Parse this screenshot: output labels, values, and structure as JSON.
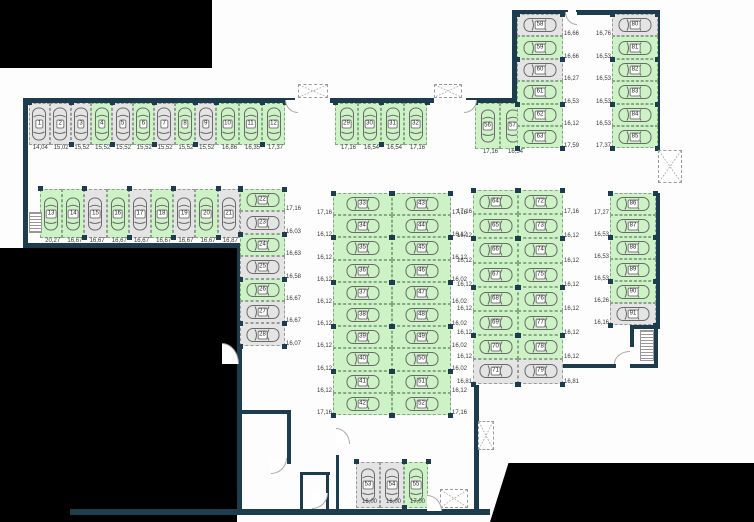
{
  "plan": {
    "colors": {
      "wall": "#1d3c4e",
      "free_stall": "#ccf2c5",
      "occupied_stall": "#e4e4e4",
      "background": "#fdfdfd",
      "outside": "#000000"
    },
    "outside": [
      {
        "x": 0,
        "y": 0,
        "w": 212,
        "h": 68
      },
      {
        "x": 0,
        "y": 248,
        "w": 237,
        "h": 274
      },
      {
        "x": 490,
        "y": 463,
        "w": 264,
        "h": 59,
        "clip": "polygon(0 100%, 7% 0, 100% 0, 100% 100%)"
      }
    ],
    "walls": [
      {
        "x": 23,
        "y": 98,
        "w": 272,
        "h": 5
      },
      {
        "x": 330,
        "y": 98,
        "w": 104,
        "h": 5
      },
      {
        "x": 466,
        "y": 98,
        "w": 52,
        "h": 5
      },
      {
        "x": 512,
        "y": 10,
        "w": 56,
        "h": 5
      },
      {
        "x": 576,
        "y": 10,
        "w": 84,
        "h": 5
      },
      {
        "x": 655,
        "y": 10,
        "w": 5,
        "h": 140
      },
      {
        "x": 512,
        "y": 10,
        "w": 5,
        "h": 95
      },
      {
        "x": 23,
        "y": 98,
        "w": 5,
        "h": 150
      },
      {
        "x": 23,
        "y": 243,
        "w": 218,
        "h": 5
      },
      {
        "x": 237,
        "y": 243,
        "w": 5,
        "h": 271
      },
      {
        "x": 70,
        "y": 509,
        "w": 420,
        "h": 6
      },
      {
        "x": 655,
        "y": 193,
        "w": 5,
        "h": 136
      },
      {
        "x": 630,
        "y": 325,
        "w": 28,
        "h": 4
      },
      {
        "x": 630,
        "y": 325,
        "w": 4,
        "h": 22
      },
      {
        "x": 654,
        "y": 325,
        "w": 4,
        "h": 43
      },
      {
        "x": 560,
        "y": 364,
        "w": 56,
        "h": 4
      },
      {
        "x": 630,
        "y": 364,
        "w": 28,
        "h": 4
      },
      {
        "x": 474,
        "y": 385,
        "w": 5,
        "h": 126
      },
      {
        "x": 238,
        "y": 410,
        "w": 53,
        "h": 4
      },
      {
        "x": 287,
        "y": 410,
        "w": 4,
        "h": 54
      },
      {
        "x": 300,
        "y": 472,
        "w": 30,
        "h": 3
      },
      {
        "x": 300,
        "y": 472,
        "w": 3,
        "h": 38
      },
      {
        "x": 326,
        "y": 472,
        "w": 3,
        "h": 38
      },
      {
        "x": 336,
        "y": 455,
        "w": 3,
        "h": 55
      }
    ],
    "hatches": [
      {
        "x": 298,
        "y": 84,
        "w": 30,
        "h": 14
      },
      {
        "x": 434,
        "y": 84,
        "w": 28,
        "h": 14
      },
      {
        "x": 658,
        "y": 150,
        "w": 24,
        "h": 33
      },
      {
        "x": 478,
        "y": 421,
        "w": 16,
        "h": 29
      },
      {
        "x": 440,
        "y": 489,
        "w": 28,
        "h": 19
      }
    ],
    "doors": [
      {
        "x": 285,
        "y": 100,
        "w": 13,
        "h": 13,
        "q": "bl"
      },
      {
        "x": 464,
        "y": 100,
        "w": 13,
        "h": 13,
        "q": "br"
      },
      {
        "x": 565,
        "y": 12,
        "w": 12,
        "h": 13,
        "q": "bl"
      },
      {
        "x": 222,
        "y": 343,
        "w": 17,
        "h": 21,
        "q": "tr"
      },
      {
        "x": 271,
        "y": 458,
        "w": 16,
        "h": 16,
        "q": "br"
      },
      {
        "x": 312,
        "y": 493,
        "w": 16,
        "h": 16,
        "q": "br"
      },
      {
        "x": 427,
        "y": 495,
        "w": 15,
        "h": 16,
        "q": "tr"
      },
      {
        "x": 614,
        "y": 351,
        "w": 16,
        "h": 13,
        "q": "tl"
      },
      {
        "x": 336,
        "y": 428,
        "w": 14,
        "h": 16,
        "q": "tr"
      }
    ],
    "stairs": [
      {
        "x": 29,
        "y": 212,
        "w": 13,
        "h": 21
      },
      {
        "x": 640,
        "y": 330,
        "w": 14,
        "h": 31
      }
    ],
    "blocks": [
      {
        "id": "row-1-9",
        "type": "row",
        "x": 29,
        "y": 103,
        "sw": 20.8,
        "sh": 42,
        "dim": "below",
        "stalls": [
          {
            "n": "1",
            "dim": "14,04",
            "free": false
          },
          {
            "n": "2",
            "dim": "15,02",
            "free": false
          },
          {
            "n": "3",
            "dim": "15,52",
            "free": false
          },
          {
            "n": "4",
            "dim": "15,52",
            "free": true
          },
          {
            "n": "5",
            "dim": "15,52",
            "free": false
          },
          {
            "n": "6",
            "dim": "15,52",
            "free": true
          },
          {
            "n": "7",
            "dim": "15,52",
            "free": false
          },
          {
            "n": "8",
            "dim": "15,52",
            "free": true
          },
          {
            "n": "9",
            "dim": "15,52",
            "free": false
          }
        ]
      },
      {
        "id": "row-10-12",
        "type": "row",
        "x": 216,
        "y": 103,
        "sw": 23,
        "sh": 42,
        "dim": "below",
        "stalls": [
          {
            "n": "10",
            "dim": "16,86",
            "free": true
          },
          {
            "n": "11",
            "dim": "16,35",
            "free": true
          },
          {
            "n": "12",
            "dim": "17,37",
            "free": true
          }
        ]
      },
      {
        "id": "row-29-32",
        "type": "row",
        "x": 335,
        "y": 103,
        "sw": 23,
        "sh": 42,
        "dim": "below",
        "stalls": [
          {
            "n": "29",
            "dim": "17,16",
            "free": true
          },
          {
            "n": "30",
            "dim": "16,54",
            "free": true
          },
          {
            "n": "31",
            "dim": "16,54",
            "free": true
          },
          {
            "n": "32",
            "dim": "17,16",
            "free": true
          }
        ]
      },
      {
        "id": "row-13-21",
        "type": "row",
        "x": 40,
        "y": 189,
        "sw": 22.2,
        "sh": 49,
        "dim": "below",
        "stalls": [
          {
            "n": "13",
            "dim": "20,27",
            "free": true
          },
          {
            "n": "14",
            "dim": "16,67",
            "free": true
          },
          {
            "n": "15",
            "dim": "16,67",
            "free": false
          },
          {
            "n": "16",
            "dim": "16,67",
            "free": true
          },
          {
            "n": "17",
            "dim": "16,67",
            "free": false
          },
          {
            "n": "18",
            "dim": "16,67",
            "free": true
          },
          {
            "n": "19",
            "dim": "16,67",
            "free": false
          },
          {
            "n": "20",
            "dim": "16,67",
            "free": true
          },
          {
            "n": "21",
            "dim": "16,87",
            "free": false
          }
        ]
      },
      {
        "id": "col-22-28",
        "type": "col",
        "x": 240,
        "y": 189,
        "w": 45,
        "sh": 22.4,
        "dim": "right",
        "stalls": [
          {
            "n": "22",
            "dim": "17,16",
            "free": true
          },
          {
            "n": "23",
            "dim": "16,03",
            "free": false
          },
          {
            "n": "24",
            "dim": "16,63",
            "free": true
          },
          {
            "n": "25",
            "dim": "16,58",
            "free": false
          },
          {
            "n": "26",
            "dim": "16,67",
            "free": true
          },
          {
            "n": "27",
            "dim": "16,67",
            "free": false
          },
          {
            "n": "28",
            "dim": "16,07",
            "free": false
          }
        ]
      },
      {
        "id": "col-33-42",
        "type": "col",
        "x": 333,
        "y": 193,
        "w": 59,
        "sh": 22.2,
        "dim": "left",
        "stalls": [
          {
            "n": "33",
            "dim": "17,16",
            "free": true
          },
          {
            "n": "34",
            "dim": "16,12",
            "free": true
          },
          {
            "n": "35",
            "dim": "16,12",
            "free": true
          },
          {
            "n": "36",
            "dim": "16,12",
            "free": true
          },
          {
            "n": "37",
            "dim": "16,12",
            "free": true
          },
          {
            "n": "38",
            "dim": "16,12",
            "free": true
          },
          {
            "n": "39",
            "dim": "16,12",
            "free": true
          },
          {
            "n": "40",
            "dim": "16,12",
            "free": true
          },
          {
            "n": "41",
            "dim": "16,12",
            "free": true
          },
          {
            "n": "42",
            "dim": "17,16",
            "free": true
          }
        ]
      },
      {
        "id": "col-43-52",
        "type": "col",
        "x": 392,
        "y": 193,
        "w": 59,
        "sh": 22.2,
        "dim": "right",
        "stalls": [
          {
            "n": "43",
            "dim": "17,16",
            "free": true
          },
          {
            "n": "44",
            "dim": "16,12",
            "free": true
          },
          {
            "n": "45",
            "dim": "16,12",
            "free": true
          },
          {
            "n": "46",
            "dim": "16,02",
            "free": true
          },
          {
            "n": "47",
            "dim": "16,02",
            "free": true
          },
          {
            "n": "48",
            "dim": "16,02",
            "free": true
          },
          {
            "n": "49",
            "dim": "16,02",
            "free": true
          },
          {
            "n": "50",
            "dim": "16,02",
            "free": true
          },
          {
            "n": "51",
            "dim": "16,12",
            "free": true
          },
          {
            "n": "52",
            "dim": "17,16",
            "free": true
          }
        ]
      },
      {
        "id": "row-56-57",
        "type": "row",
        "x": 475,
        "y": 103,
        "sw": 25,
        "sh": 46,
        "dim": "below",
        "stalls": [
          {
            "n": "56",
            "dim": "17,16",
            "free": true
          },
          {
            "n": "57",
            "dim": "16,54",
            "free": true
          }
        ]
      },
      {
        "id": "col-58-63",
        "type": "col",
        "x": 517,
        "y": 14,
        "w": 46,
        "sh": 22.4,
        "dim": "right",
        "stalls": [
          {
            "n": "58",
            "dim": "16,66",
            "free": false
          },
          {
            "n": "59",
            "dim": "16,66",
            "free": true
          },
          {
            "n": "60",
            "dim": "16,27",
            "free": false
          },
          {
            "n": "61",
            "dim": "16,53",
            "free": true
          },
          {
            "n": "62",
            "dim": "16,12",
            "free": true
          },
          {
            "n": "63",
            "dim": "17,59",
            "free": true
          }
        ]
      },
      {
        "id": "col-80-85",
        "type": "col",
        "x": 612,
        "y": 14,
        "w": 46,
        "sh": 22.4,
        "dim": "left",
        "stalls": [
          {
            "n": "80",
            "dim": "16,76",
            "free": false
          },
          {
            "n": "81",
            "dim": "16,53",
            "free": true
          },
          {
            "n": "82",
            "dim": "16,53",
            "free": true
          },
          {
            "n": "83",
            "dim": "16,53",
            "free": true
          },
          {
            "n": "84",
            "dim": "16,53",
            "free": true
          },
          {
            "n": "85",
            "dim": "17,37",
            "free": true
          }
        ]
      },
      {
        "id": "col-64-71",
        "type": "col",
        "x": 473,
        "y": 190,
        "w": 45,
        "sh": 24.2,
        "dim": "left",
        "stalls": [
          {
            "n": "64",
            "dim": "17,16",
            "free": true
          },
          {
            "n": "65",
            "dim": "16,12",
            "free": true
          },
          {
            "n": "66",
            "dim": "16,12",
            "free": true
          },
          {
            "n": "67",
            "dim": "16,12",
            "free": true
          },
          {
            "n": "68",
            "dim": "16,12",
            "free": true
          },
          {
            "n": "69",
            "dim": "16,12",
            "free": true
          },
          {
            "n": "70",
            "dim": "16,12",
            "free": true
          },
          {
            "n": "71",
            "dim": "16,81",
            "free": false
          }
        ]
      },
      {
        "id": "col-72-79",
        "type": "col",
        "x": 518,
        "y": 190,
        "w": 45,
        "sh": 24.2,
        "dim": "right",
        "stalls": [
          {
            "n": "72",
            "dim": "17,16",
            "free": true
          },
          {
            "n": "73",
            "dim": "16,12",
            "free": true
          },
          {
            "n": "74",
            "dim": "16,12",
            "free": true
          },
          {
            "n": "75",
            "dim": "16,12",
            "free": true
          },
          {
            "n": "76",
            "dim": "16,12",
            "free": true
          },
          {
            "n": "77",
            "dim": "16,12",
            "free": true
          },
          {
            "n": "78",
            "dim": "16,12",
            "free": true
          },
          {
            "n": "79",
            "dim": "16,81",
            "free": false
          }
        ]
      },
      {
        "id": "col-86-91",
        "type": "col",
        "x": 610,
        "y": 193,
        "w": 46,
        "sh": 22,
        "dim": "left",
        "stalls": [
          {
            "n": "86",
            "dim": "17,27",
            "free": true
          },
          {
            "n": "87",
            "dim": "16,53",
            "free": true
          },
          {
            "n": "88",
            "dim": "16,53",
            "free": true
          },
          {
            "n": "89",
            "dim": "16,53",
            "free": true
          },
          {
            "n": "90",
            "dim": "16,26",
            "free": true
          },
          {
            "n": "91",
            "dim": "16,16",
            "free": false
          }
        ]
      },
      {
        "id": "row-53-55",
        "type": "row",
        "x": 356,
        "y": 462,
        "sw": 24,
        "sh": 46,
        "dim": "inside",
        "stalls": [
          {
            "n": "53",
            "dim": "16,00",
            "free": false
          },
          {
            "n": "54",
            "dim": "16,00",
            "free": false
          },
          {
            "n": "55",
            "dim": "17,00",
            "free": true
          }
        ]
      }
    ]
  }
}
